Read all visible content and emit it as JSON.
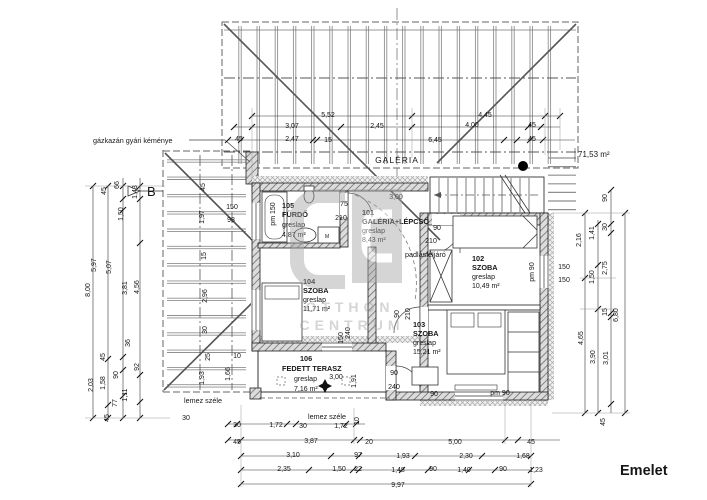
{
  "drawing_title": "Emelet",
  "total_area": "71,53 m²",
  "section_letter": "B",
  "galeria_label": "GALÉRIA",
  "chimney_note": "gázkazán gyári kéménye",
  "attic_access_label": "padlásfeljáró",
  "slab_edge_label_1": "lemez széle",
  "slab_edge_label_2": "lemez széle",
  "washing_machine_label": "M",
  "watermark": {
    "line1": "OTTHON",
    "line2": "CENTRUM"
  },
  "rooms": [
    {
      "number": "105",
      "name": "FÜRDŐ",
      "finish": "greslap",
      "area": "4,87 m²"
    },
    {
      "number": "101",
      "name": "GALÉRIA+LÉPCSŐ",
      "finish": "greslap",
      "area": "8,43 m²"
    },
    {
      "number": "104",
      "name": "SZOBA",
      "finish": "greslap",
      "area": "11,71 m²"
    },
    {
      "number": "102",
      "name": "SZOBA",
      "finish": "greslap",
      "area": "10,49 m²"
    },
    {
      "number": "103",
      "name": "SZOBA",
      "finish": "greslap",
      "area": "15,21 m²"
    },
    {
      "number": "106",
      "name": "FEDETT TERASZ",
      "finish": "greslap",
      "area": "7,16 m²"
    }
  ],
  "dims": [
    {
      "t": "5,52",
      "x": 328,
      "y": 117
    },
    {
      "t": "4,45",
      "x": 485,
      "y": 117
    },
    {
      "t": "3,07",
      "x": 292,
      "y": 128
    },
    {
      "t": "2,45",
      "x": 377,
      "y": 128
    },
    {
      "t": "4,00",
      "x": 472,
      "y": 127
    },
    {
      "t": "45",
      "x": 532,
      "y": 127
    },
    {
      "t": "45",
      "x": 239,
      "y": 141
    },
    {
      "t": "2,47",
      "x": 292,
      "y": 141
    },
    {
      "t": "15",
      "x": 328,
      "y": 142
    },
    {
      "t": "6,45",
      "x": 435,
      "y": 142
    },
    {
      "t": "45",
      "x": 532,
      "y": 141
    },
    {
      "t": "45",
      "x": 237,
      "y": 444
    },
    {
      "t": "3,87",
      "x": 311,
      "y": 443
    },
    {
      "t": "20",
      "x": 369,
      "y": 444
    },
    {
      "t": "5,00",
      "x": 455,
      "y": 444
    },
    {
      "t": "45",
      "x": 531,
      "y": 444
    },
    {
      "t": "3,10",
      "x": 293,
      "y": 457
    },
    {
      "t": "97",
      "x": 358,
      "y": 457
    },
    {
      "t": "1,93",
      "x": 403,
      "y": 458
    },
    {
      "t": "2,30",
      "x": 466,
      "y": 458
    },
    {
      "t": "1,68",
      "x": 523,
      "y": 458
    },
    {
      "t": "2,35",
      "x": 284,
      "y": 471
    },
    {
      "t": "1,50",
      "x": 339,
      "y": 471
    },
    {
      "t": "22",
      "x": 358,
      "y": 471
    },
    {
      "t": "1,48",
      "x": 398,
      "y": 472
    },
    {
      "t": "90",
      "x": 433,
      "y": 471
    },
    {
      "t": "1,40",
      "x": 464,
      "y": 472
    },
    {
      "t": "90",
      "x": 503,
      "y": 471
    },
    {
      "t": "1,23",
      "x": 536,
      "y": 472
    },
    {
      "t": "9,97",
      "x": 398,
      "y": 487
    },
    {
      "t": "30",
      "x": 186,
      "y": 420
    },
    {
      "t": "30",
      "x": 237,
      "y": 427
    },
    {
      "t": "1,72",
      "x": 276,
      "y": 427
    },
    {
      "t": "30",
      "x": 303,
      "y": 428
    },
    {
      "t": "1,72",
      "x": 341,
      "y": 428
    },
    {
      "t": "10",
      "x": 359,
      "y": 421,
      "r": 1
    },
    {
      "t": "45",
      "x": 106,
      "y": 191,
      "r": 1
    },
    {
      "t": "66",
      "x": 119,
      "y": 185,
      "r": 1
    },
    {
      "t": "1,43",
      "x": 137,
      "y": 192,
      "r": 1
    },
    {
      "t": "1,50",
      "x": 123,
      "y": 214,
      "r": 1
    },
    {
      "t": "5,97",
      "x": 96,
      "y": 265,
      "r": 1
    },
    {
      "t": "5,07",
      "x": 111,
      "y": 267,
      "r": 1
    },
    {
      "t": "8,00",
      "x": 90,
      "y": 290,
      "r": 1
    },
    {
      "t": "3,81",
      "x": 127,
      "y": 288,
      "r": 1
    },
    {
      "t": "4,56",
      "x": 139,
      "y": 287,
      "r": 1
    },
    {
      "t": "36",
      "x": 130,
      "y": 343,
      "r": 1
    },
    {
      "t": "45",
      "x": 105,
      "y": 357,
      "r": 1
    },
    {
      "t": "92",
      "x": 139,
      "y": 367,
      "r": 1
    },
    {
      "t": "90",
      "x": 118,
      "y": 375,
      "r": 1
    },
    {
      "t": "1,58",
      "x": 105,
      "y": 383,
      "r": 1
    },
    {
      "t": "2,03",
      "x": 93,
      "y": 385,
      "r": 1
    },
    {
      "t": "1,11",
      "x": 127,
      "y": 395,
      "r": 1
    },
    {
      "t": "77",
      "x": 117,
      "y": 403,
      "r": 1
    },
    {
      "t": "45",
      "x": 109,
      "y": 418,
      "r": 1
    },
    {
      "t": "45",
      "x": 205,
      "y": 187,
      "r": 1
    },
    {
      "t": "150",
      "x": 232,
      "y": 209
    },
    {
      "t": "98",
      "x": 231,
      "y": 222
    },
    {
      "t": "1,97",
      "x": 204,
      "y": 217,
      "r": 1
    },
    {
      "t": "15",
      "x": 206,
      "y": 256,
      "r": 1
    },
    {
      "t": "2,96",
      "x": 207,
      "y": 296,
      "r": 1
    },
    {
      "t": "30",
      "x": 207,
      "y": 330,
      "r": 1
    },
    {
      "t": "25",
      "x": 210,
      "y": 357,
      "r": 1
    },
    {
      "t": "10",
      "x": 237,
      "y": 358
    },
    {
      "t": "1,66",
      "x": 230,
      "y": 374,
      "r": 1
    },
    {
      "t": "1,93",
      "x": 204,
      "y": 378,
      "r": 1
    },
    {
      "t": "90",
      "x": 607,
      "y": 198,
      "r": 1
    },
    {
      "t": "30",
      "x": 607,
      "y": 227,
      "r": 1
    },
    {
      "t": "1,41",
      "x": 594,
      "y": 233,
      "r": 1
    },
    {
      "t": "2,16",
      "x": 581,
      "y": 240,
      "r": 1
    },
    {
      "t": "2,75",
      "x": 607,
      "y": 268,
      "r": 1
    },
    {
      "t": "1,50",
      "x": 594,
      "y": 277,
      "r": 1
    },
    {
      "t": "15",
      "x": 607,
      "y": 312,
      "r": 1
    },
    {
      "t": "6,80",
      "x": 618,
      "y": 315,
      "r": 1
    },
    {
      "t": "4,65",
      "x": 583,
      "y": 338,
      "r": 1
    },
    {
      "t": "3,90",
      "x": 595,
      "y": 357,
      "r": 1
    },
    {
      "t": "3,01",
      "x": 608,
      "y": 358,
      "r": 1
    },
    {
      "t": "45",
      "x": 605,
      "y": 422,
      "r": 1
    },
    {
      "t": "150",
      "x": 564,
      "y": 269
    },
    {
      "t": "150",
      "x": 564,
      "y": 282
    },
    {
      "t": "pm 90",
      "x": 534,
      "y": 272,
      "r": 1
    },
    {
      "t": "pm 150",
      "x": 275,
      "y": 214,
      "r": 1
    },
    {
      "t": "75",
      "x": 344,
      "y": 206
    },
    {
      "t": "210",
      "x": 341,
      "y": 220
    },
    {
      "t": "3,00",
      "x": 396,
      "y": 199
    },
    {
      "t": "90",
      "x": 437,
      "y": 230
    },
    {
      "t": "210",
      "x": 431,
      "y": 243
    },
    {
      "t": "90",
      "x": 399,
      "y": 314,
      "r": 1
    },
    {
      "t": "210",
      "x": 410,
      "y": 314,
      "r": 1
    },
    {
      "t": "150",
      "x": 343,
      "y": 338,
      "r": 1
    },
    {
      "t": "240",
      "x": 350,
      "y": 333,
      "r": 1
    },
    {
      "t": "1,91",
      "x": 356,
      "y": 381,
      "r": 1
    },
    {
      "t": "3,00",
      "x": 336,
      "y": 379
    },
    {
      "t": "90",
      "x": 394,
      "y": 375
    },
    {
      "t": "240",
      "x": 394,
      "y": 389
    },
    {
      "t": "90",
      "x": 434,
      "y": 396
    },
    {
      "t": "pm 90",
      "x": 500,
      "y": 395
    }
  ]
}
